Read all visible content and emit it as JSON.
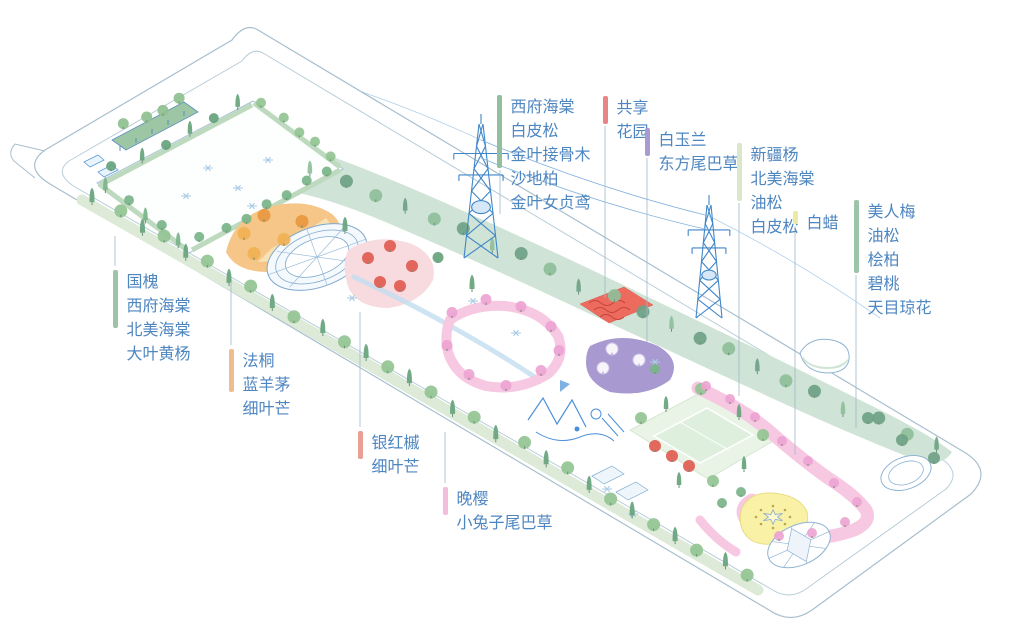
{
  "figure": {
    "title": "park-planting-axonometric-plan",
    "background": "#ffffff",
    "label_text_color": "#4e86c0",
    "linework_color": "#a8bfce",
    "tower_color": "#3f86c9"
  },
  "palette": {
    "berm_green": "#cfe4d6",
    "tree_dark": "#66a37c",
    "tree_light": "#93c493",
    "tree_mint": "#8fbf9a",
    "tree_sage": "#6fa287",
    "hedge": "#7ab489",
    "orange_zone": "#f5c687",
    "orange_tree": "#e8973f",
    "red_zone_ground": "#f8dbde",
    "red_tree": "#e05c50",
    "pink_path": "#f7c8e2",
    "pink_tree": "#eda4d3",
    "purple_zone": "#a89ad0",
    "blossom_white": "#f7f4fc",
    "red_patch": "#ed6a5f",
    "lawn": "#e9f4e6",
    "yellow_plaza": "#f8f1a6",
    "water_line": "#8fb3d4",
    "playground_blue": "#4a90d9",
    "paving_flake": "#aacbe6"
  },
  "legend": {
    "labels": [
      {
        "id": "north-berm-mix",
        "bar_color": "#93bf9e",
        "x": 497,
        "y": 93,
        "lines": [
          "西府海棠",
          "白皮松",
          "金叶接骨木",
          "沙地柏",
          "金叶女贞鸢"
        ],
        "leader": {
          "x": 500,
          "y1": 170,
          "y2": 214
        }
      },
      {
        "id": "shared-garden",
        "bar_color": "#e98585",
        "x": 603,
        "y": 94,
        "lines": [
          "共享",
          "花园"
        ],
        "leader": {
          "x": 605,
          "y1": 126,
          "y2": 298
        }
      },
      {
        "id": "magnolia-bed",
        "bar_color": "#a79bd0",
        "x": 645,
        "y": 126,
        "lines": [
          "白玉兰",
          "东方尾巴草"
        ],
        "leader": {
          "x": 647,
          "y1": 158,
          "y2": 342
        }
      },
      {
        "id": "poplar-mix",
        "bar_color": "#dbe7c9",
        "x": 737,
        "y": 141,
        "lines": [
          "新疆杨",
          "北美海棠",
          "油松",
          "白皮松"
        ],
        "leader": {
          "x": 739,
          "y1": 203,
          "y2": 396
        }
      },
      {
        "id": "ash",
        "bar_color": "#efe9a6",
        "x": 793,
        "y": 209,
        "lines": [
          "白蜡"
        ],
        "leader": {
          "x": 795,
          "y1": 226,
          "y2": 455
        }
      },
      {
        "id": "east-end-mix",
        "bar_color": "#9cc4a9",
        "x": 854,
        "y": 198,
        "lines": [
          "美人梅",
          "油松",
          "桧柏",
          "碧桃",
          "天目琼花"
        ],
        "leader": {
          "x": 856,
          "y1": 275,
          "y2": 428
        }
      },
      {
        "id": "west-entry-mix",
        "bar_color": "#9cc4a9",
        "x": 113,
        "y": 268,
        "lines": [
          "国槐",
          "西府海棠",
          "北美海棠",
          "大叶黄杨"
        ],
        "leader": {
          "x": 115,
          "y1": 266,
          "y2": 236
        }
      },
      {
        "id": "plane-tree-bed",
        "bar_color": "#eebc8d",
        "x": 229,
        "y": 347,
        "lines": [
          "法桐",
          "蓝羊茅",
          "细叶芒"
        ],
        "leader": {
          "x": 231,
          "y1": 345,
          "y2": 282
        }
      },
      {
        "id": "red-maple-bed",
        "bar_color": "#e7a093",
        "x": 358,
        "y": 429,
        "lines": [
          "银红槭",
          "细叶芒"
        ],
        "leader": {
          "x": 360,
          "y1": 427,
          "y2": 312
        }
      },
      {
        "id": "late-cherry-walk",
        "bar_color": "#f3bedb",
        "x": 443,
        "y": 485,
        "lines": [
          "晚樱",
          "小兔子尾巴草"
        ],
        "leader": {
          "x": 445,
          "y1": 483,
          "y2": 432
        }
      }
    ]
  },
  "map": {
    "zones": [
      "west-entry-plaza",
      "pergola",
      "orange-autumn-garden",
      "circular-fountain-plaza",
      "red-maple-garden",
      "shared-flower-garden",
      "magnolia-purple-garden",
      "sports-lawn",
      "pink-cherry-loop",
      "late-cherry-walk",
      "yellow-sun-plaza",
      "star-compass-plaza",
      "east-lawn-circle",
      "northeast-tree-berm",
      "southwest-tree-row",
      "east-pond"
    ],
    "structures": [
      "site-boundary-road",
      "transmission-tower-west",
      "transmission-tower-east",
      "power-lines"
    ]
  }
}
